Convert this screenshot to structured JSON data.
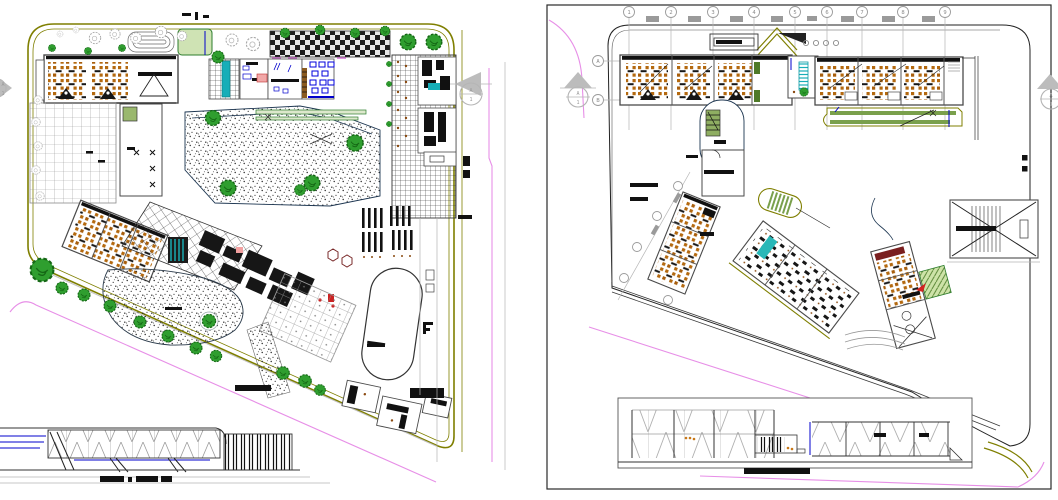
{
  "document": {
    "kind": "architectural CAD drawing, two floor plans with elevations"
  },
  "colors": {
    "line": "#1a1a1a",
    "boundary": "#7f7f00",
    "road": "#e78fe7",
    "tree": "#2f9e2f",
    "tree_dark": "#156715",
    "gray": "#9d9d9d",
    "desk": "#b4690f",
    "cyan": "#17aeb8",
    "blue": "#0000cc",
    "green_fill": "#7aa04c",
    "red": "#cc2222",
    "black_fill": "#111111"
  },
  "left_plan": {
    "marker_right": {
      "letter": "A",
      "number": "1"
    },
    "marker_left": {
      "letter": "A",
      "number": "1"
    }
  },
  "right_plan": {
    "grid_columns": [
      "1",
      "2",
      "3",
      "4",
      "5",
      "6",
      "7",
      "8",
      "9"
    ],
    "grid_rows": [
      "A",
      "B"
    ],
    "marker_left": {
      "letter": "A",
      "number": "1"
    },
    "marker_right": {
      "letter": "A",
      "number": "1"
    }
  }
}
